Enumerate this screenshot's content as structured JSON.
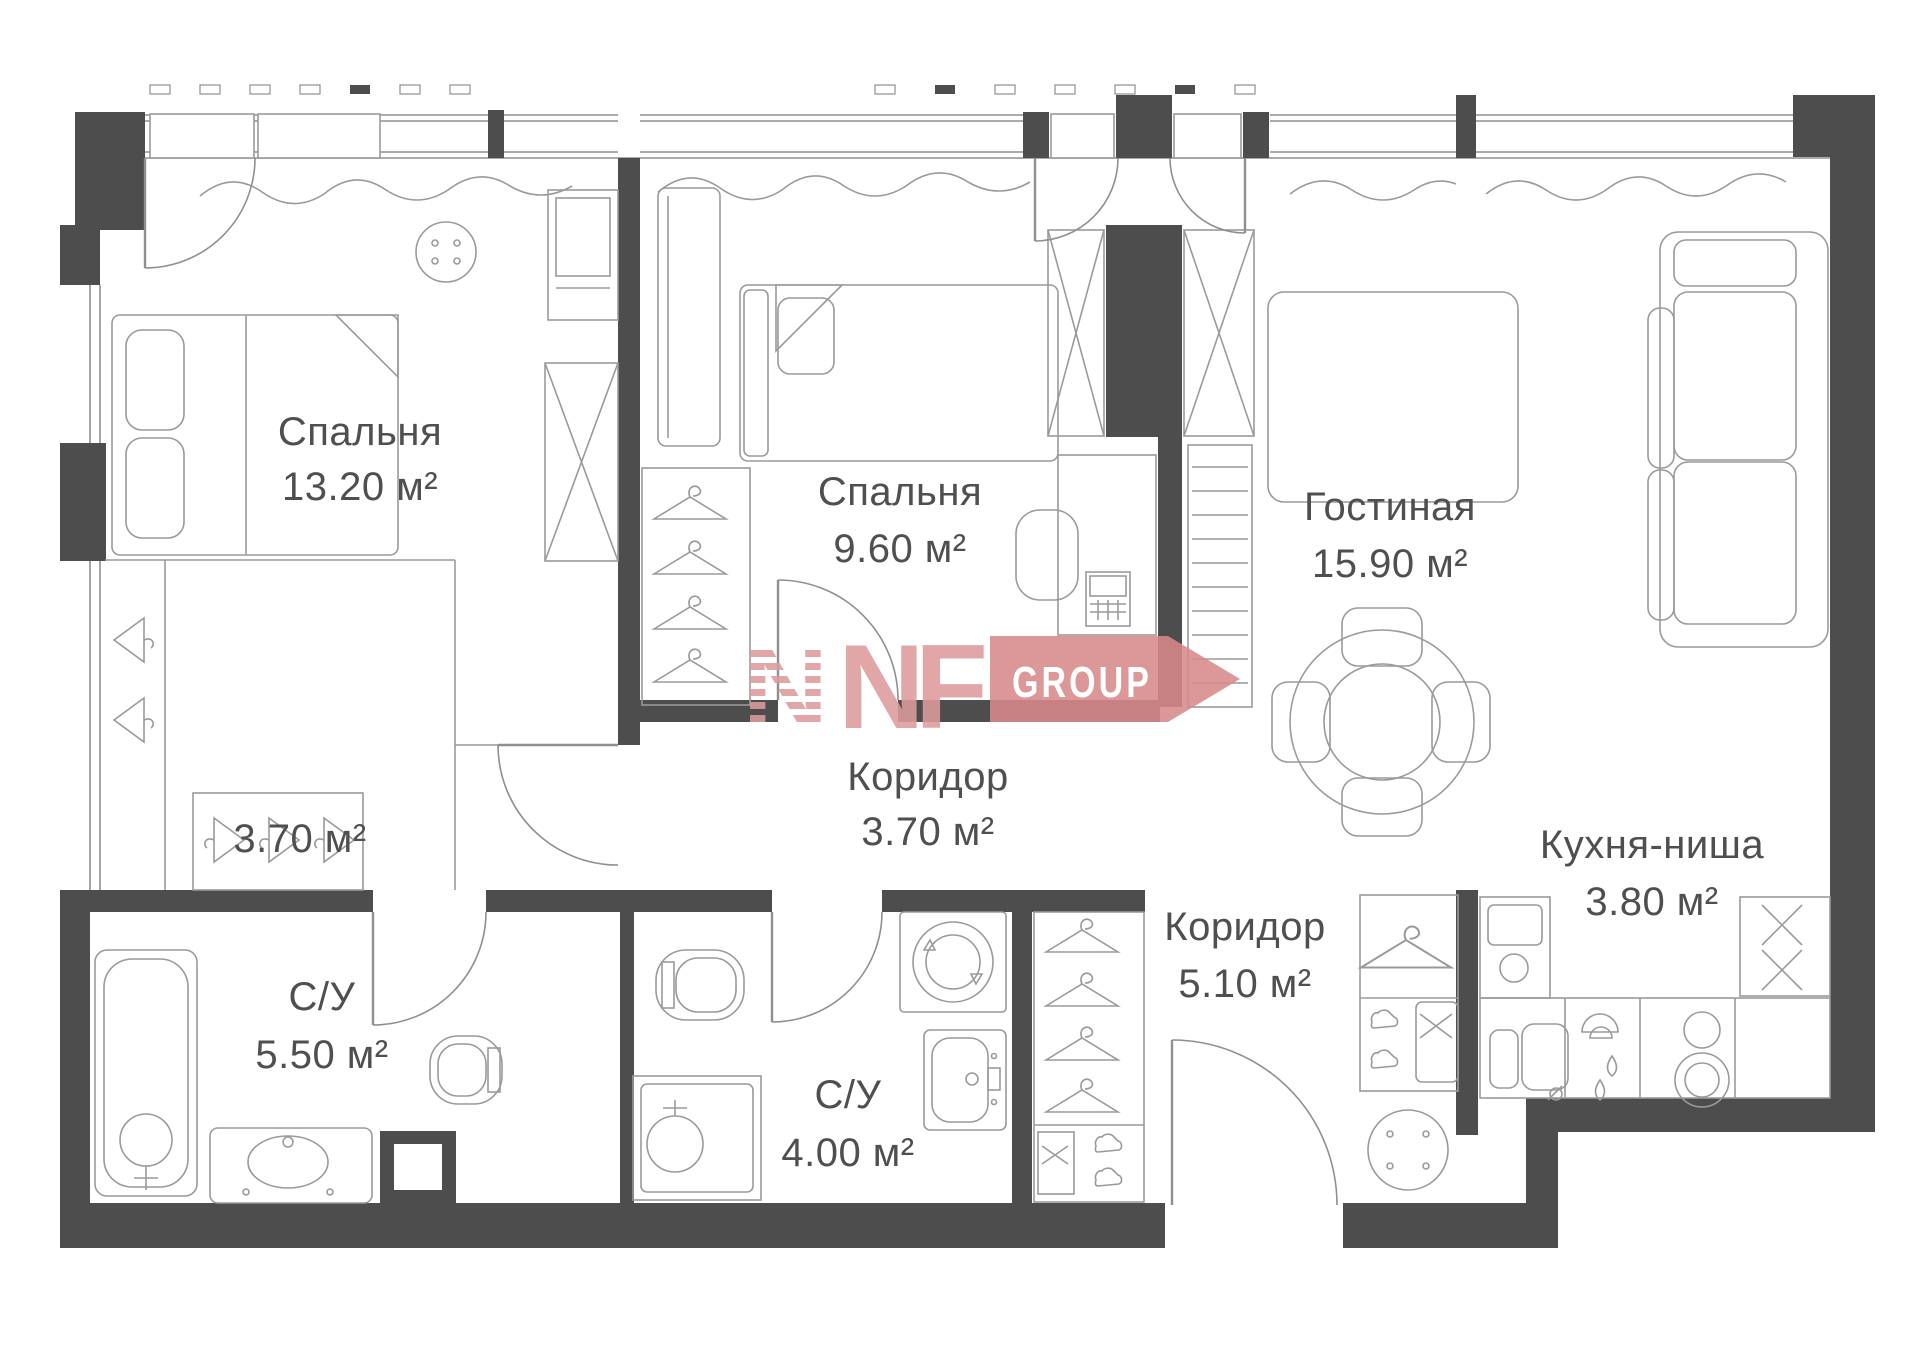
{
  "rooms": [
    {
      "name": "Спальня",
      "area": "13.20 м²"
    },
    {
      "name": "Спальня",
      "area": "9.60 м²"
    },
    {
      "name": "Гостиная",
      "area": "15.90 м²"
    },
    {
      "name": "Коридор",
      "area": "3.70 м²"
    },
    {
      "name": "Коридор",
      "area": "5.10 м²"
    },
    {
      "name": "Кухня-ниша",
      "area": "3.80 м²"
    },
    {
      "name": "С/У",
      "area": "5.50 м²"
    },
    {
      "name": "С/У",
      "area": "4.00 м²"
    },
    {
      "area": "3.70 м²"
    }
  ],
  "watermark": {
    "mark": "N",
    "letters": "NF",
    "badge": "GROUP"
  },
  "colors": {
    "wall": "#4d4d4d",
    "line": "#8f8f8f",
    "text": "#4f4f4f",
    "watermark_light": "#dd9c9d",
    "watermark_dark": "#d8898b"
  }
}
